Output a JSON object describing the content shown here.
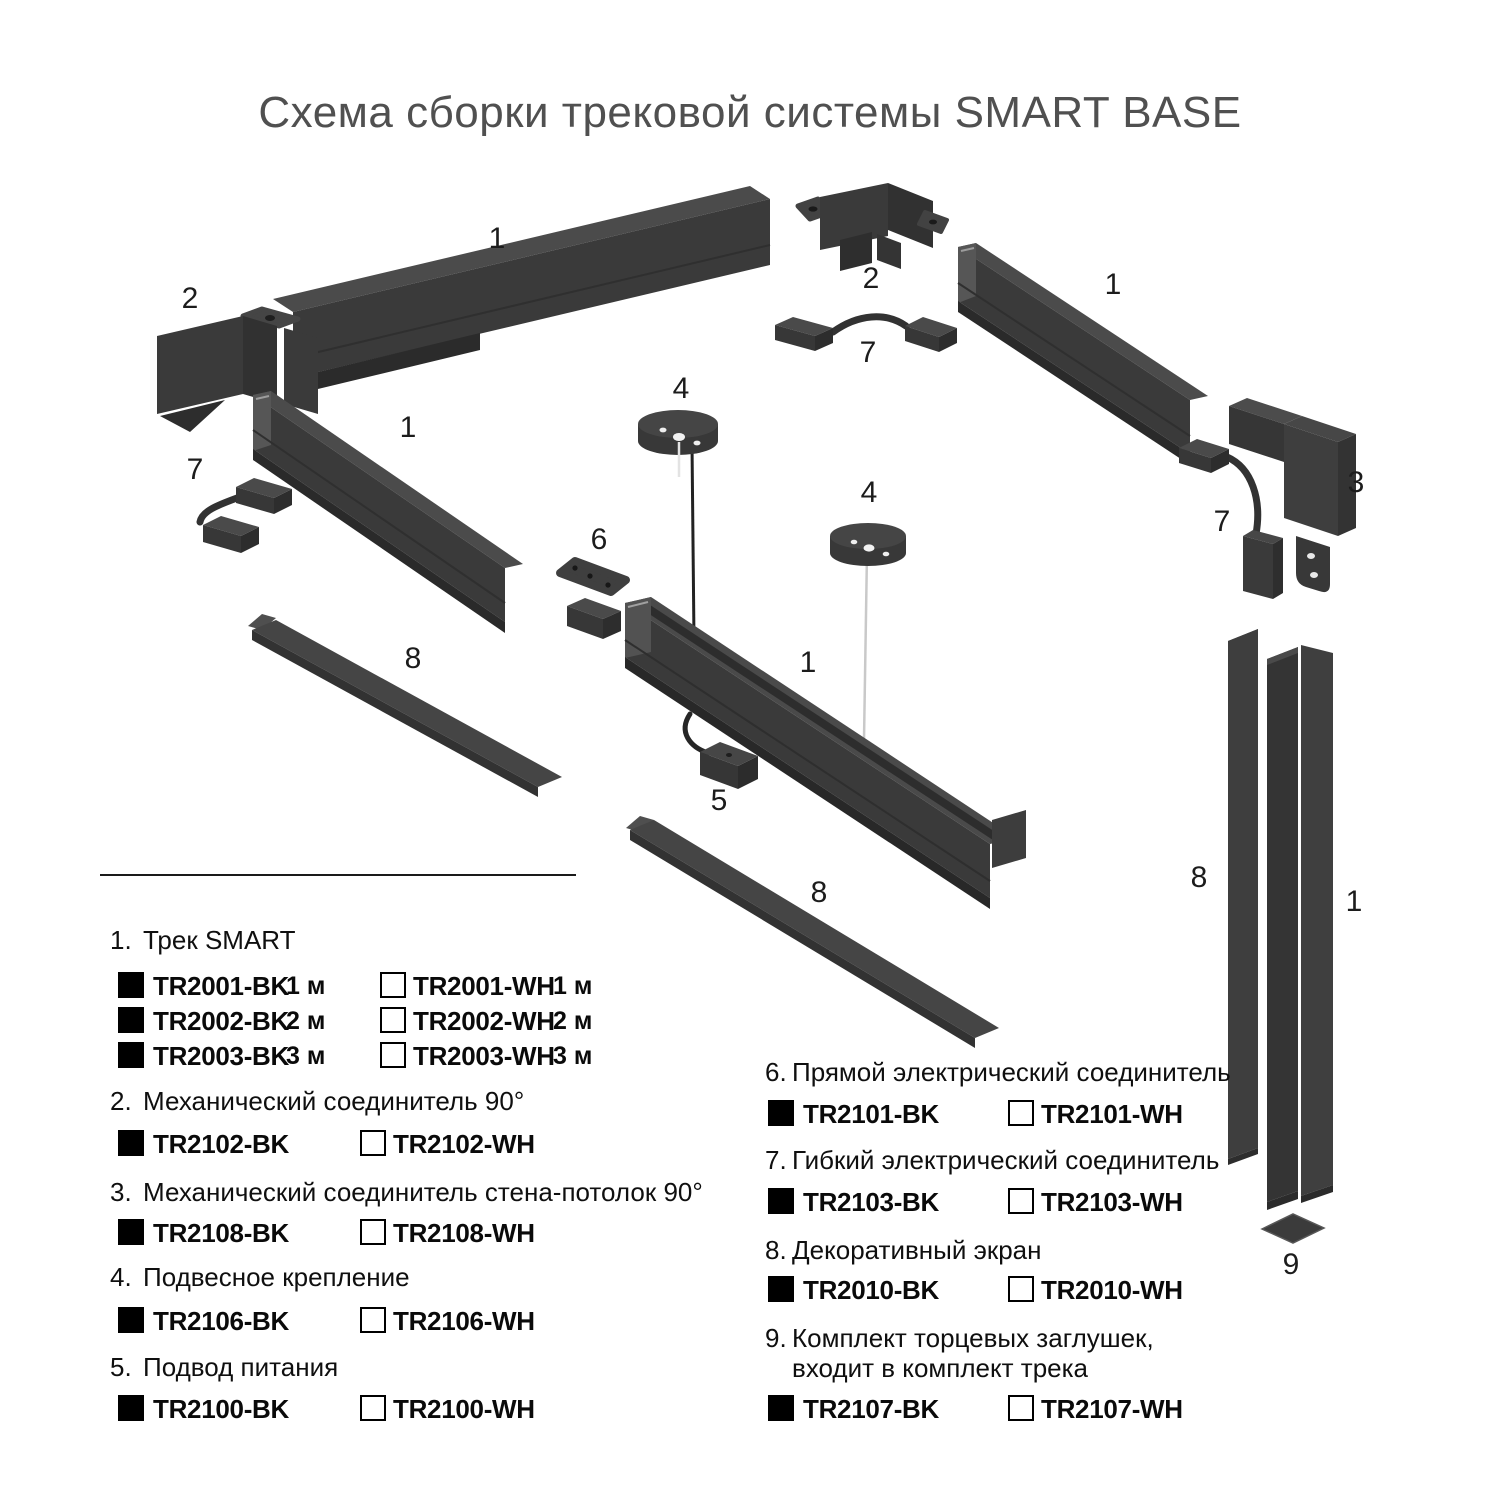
{
  "title": "Схема сборки трековой системы SMART BASE",
  "colors": {
    "part_front": "#3a3a3a",
    "part_top": "#4b4b4b",
    "part_dark": "#2d2d2d",
    "title_text": "#505050",
    "black_variant": "#000000",
    "white_variant": "#ffffff"
  },
  "diagram": {
    "part_labels": {
      "track_top_left": "1",
      "corner_left": "2",
      "track_mid_left": "1",
      "flex_left": "7",
      "screen_left": "8",
      "connector_straight": "6",
      "canopy_left": "4",
      "track_center": "1",
      "power_feed": "5",
      "screen_center": "8",
      "canopy_right": "4",
      "corner_top": "2",
      "flex_top": "7",
      "track_right": "1",
      "wall_connector": "3",
      "flex_right": "7",
      "screen_vertical": "8",
      "track_vertical": "1",
      "end_cap": "9"
    }
  },
  "legend": {
    "sections": [
      {
        "num": "1.",
        "title": "Трек SMART",
        "rows": [
          {
            "bk": "TR2001-BK",
            "bk_len": "1 м",
            "wh": "TR2001-WH",
            "wh_len": "1 м"
          },
          {
            "bk": "TR2002-BK",
            "bk_len": "2 м",
            "wh": "TR2002-WH",
            "wh_len": "2 м"
          },
          {
            "bk": "TR2003-BK",
            "bk_len": "3 м",
            "wh": "TR2003-WH",
            "wh_len": "3 м"
          }
        ]
      },
      {
        "num": "2.",
        "title": "Механический соединитель 90°",
        "rows": [
          {
            "bk": "TR2102-BK",
            "wh": "TR2102-WH"
          }
        ]
      },
      {
        "num": "3.",
        "title": "Механический соединитель стена-потолок 90°",
        "rows": [
          {
            "bk": "TR2108-BK",
            "wh": "TR2108-WH"
          }
        ]
      },
      {
        "num": "4.",
        "title": "Подвесное крепление",
        "rows": [
          {
            "bk": "TR2106-BK",
            "wh": "TR2106-WH"
          }
        ]
      },
      {
        "num": "5.",
        "title": "Подвод питания",
        "rows": [
          {
            "bk": "TR2100-BK",
            "wh": "TR2100-WH"
          }
        ]
      },
      {
        "num": "6.",
        "title": "Прямой электрический соединитель",
        "rows": [
          {
            "bk": "TR2101-BK",
            "wh": "TR2101-WH"
          }
        ]
      },
      {
        "num": "7.",
        "title": "Гибкий электрический соединитель",
        "rows": [
          {
            "bk": "TR2103-BK",
            "wh": "TR2103-WH"
          }
        ]
      },
      {
        "num": "8.",
        "title": "Декоративный экран",
        "rows": [
          {
            "bk": "TR2010-BK",
            "wh": "TR2010-WH"
          }
        ]
      },
      {
        "num": "9.",
        "title": "Комплект торцевых заглушек,",
        "title2": "входит в комплект трека",
        "rows": [
          {
            "bk": "TR2107-BK",
            "wh": "TR2107-WH"
          }
        ]
      }
    ]
  }
}
